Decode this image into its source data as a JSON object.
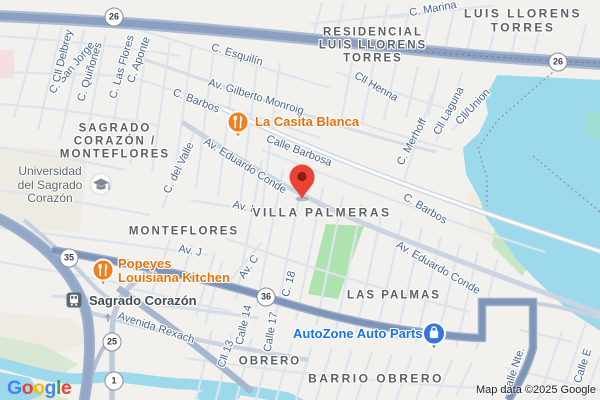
{
  "attribution": {
    "google_letters": [
      {
        "ch": "G",
        "color": "#4285F4"
      },
      {
        "ch": "o",
        "color": "#EA4335"
      },
      {
        "ch": "o",
        "color": "#FBBC05"
      },
      {
        "ch": "g",
        "color": "#4285F4"
      },
      {
        "ch": "l",
        "color": "#34A853"
      },
      {
        "ch": "e",
        "color": "#EA4335"
      }
    ],
    "map_data": "Map data ©2025 Google"
  },
  "shields": {
    "s26a": "26",
    "s26b": "26",
    "s35": "35",
    "s36": "36",
    "s25": "25",
    "s1": "1"
  },
  "areas": {
    "residencial_l1": "RESIDENCIAL",
    "residencial_l2": "LUIS LLORENS",
    "residencial_l3": "TORRES",
    "llorens_l1": "LUIS LLORENS",
    "llorens_l2": "TORRES",
    "sagrado_l1": "SAGRADO",
    "sagrado_l2": "CORAZÓN /",
    "sagrado_l3": "MONTEFLORES",
    "monteflores": "MONTEFLORES",
    "villa_palmeras": "VILLA PALMERAS",
    "las_palmas": "LAS PALMAS",
    "obrero": "OBRERO",
    "barrio_obrero": "BARRIO OBRERO"
  },
  "streets": {
    "san_jorge": "C. San Jorge",
    "delbrey": "Cll Delbrey",
    "quinones": "C. Quiñones",
    "las_flores": "C. Las Flores",
    "aponte": "C. Aponte",
    "esquilin": "C. Esquilín",
    "gilberto_monroig": "Av. Gilberto Monroig",
    "barbos_left": "C. Barbos",
    "calle_barbosa": "Calle Barbosa",
    "eduardo_conde_upper": "Av. Eduardo Conde",
    "del_valle": "C. del Valle",
    "av_i": "Av. I",
    "av_j": "Av. J",
    "av_c": "Av. C",
    "c_18": "C. 18",
    "calle_14": "Calle 14",
    "calle_17": "Calle 17",
    "cll_13": "Cll 13",
    "avenida_rexach": "Avenida Rexach",
    "cll_henna": "Cll Henna",
    "cll_laguna": "Cll Laguna",
    "cll_union": "Cll/Union",
    "merhoff": "C. Merhoff",
    "barbos_right": "C. Barbos",
    "eduardo_conde_lower": "Av. Eduardo Conde",
    "marina": "C. Marina",
    "calle_nte": "Calle Nte.",
    "calle_e": "Calle E"
  },
  "pois": {
    "casita_label": "La Casita Blanca",
    "popeyes_l1": "Popeyes",
    "popeyes_l2": "Louisiana Kitchen",
    "autozone_label": "AutoZone Auto Parts",
    "university_l1": "Universidad",
    "university_l2": "del Sagrado",
    "university_l3": "Corazón",
    "station_label": "Sagrado Corazón"
  },
  "colors": {
    "poi_orange": "#E8710A",
    "poi_blue": "#1A73E8",
    "water": "#9CDAEB",
    "park": "#AEE3AF",
    "pin_red": "#EA4335",
    "expressway": "#8BA0C1",
    "route_road": "#7E95B9"
  }
}
